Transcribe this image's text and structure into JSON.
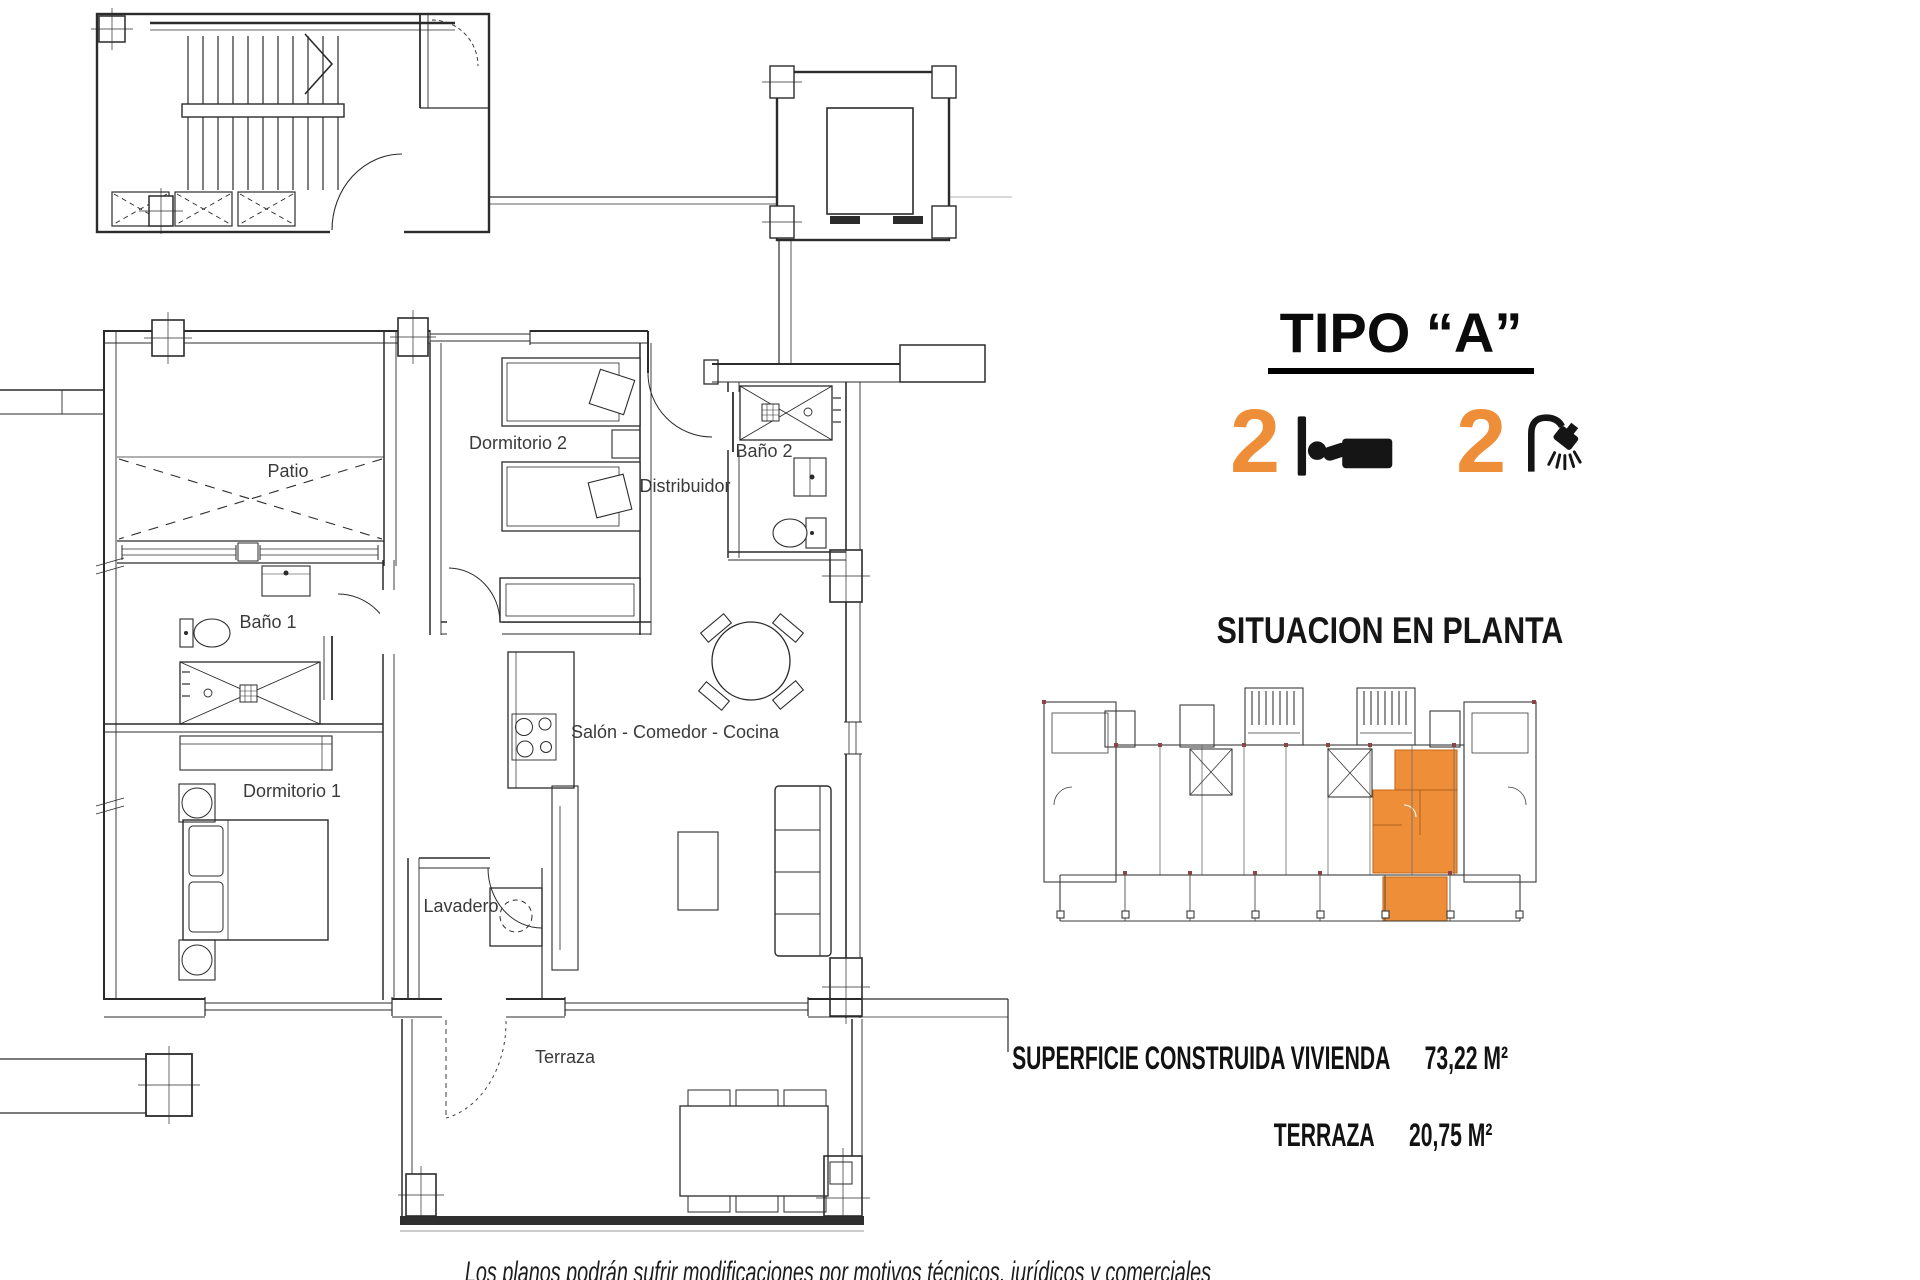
{
  "colors": {
    "accent": "#EF8E38",
    "line": "#2b2b2b"
  },
  "header": {
    "title": "TIPO “A”"
  },
  "specs": {
    "bedrooms_count": "2",
    "bathrooms_count": "2"
  },
  "situation": {
    "heading": "SITUACION EN PLANTA"
  },
  "areas": {
    "rows": [
      {
        "label": "SUPERFICIE CONSTRUIDA VIVIENDA",
        "value": "73,22 M²"
      },
      {
        "label": "TERRAZA",
        "value": "20,75 M²"
      }
    ]
  },
  "floorplan": {
    "labels": {
      "patio": "Patio",
      "dormitorio2": "Dormitorio 2",
      "distribuidor": "Distribuidor",
      "bano2": "Baño 2",
      "bano1": "Baño 1",
      "dormitorio1": "Dormitorio 1",
      "salon": "Salón - Comedor - Cocina",
      "lavadero": "Lavadero",
      "terraza": "Terraza"
    }
  },
  "footer": {
    "disclaimer": "Los planos podrán sufrir modificaciones por motivos técnicos, jurídicos y comerciales"
  }
}
